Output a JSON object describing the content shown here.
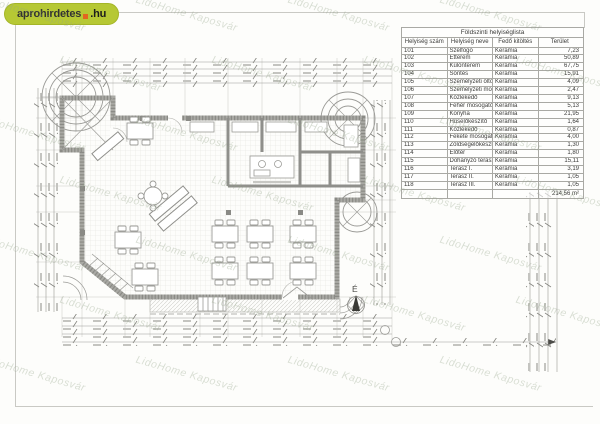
{
  "logo": {
    "text_main": "aprohirdetes",
    "text_tld": ".hu"
  },
  "watermark": {
    "text": "LidoHome Kaposvár"
  },
  "plan": {
    "north_label": "É"
  },
  "room_table": {
    "title": "Földszinti helyiséglista",
    "columns": [
      "Helyiség szám",
      "Helyiség neve",
      "Fedő kitöltés",
      "Terület"
    ],
    "row_keys": [
      "num",
      "name",
      "finish",
      "area"
    ],
    "rows": [
      {
        "num": "101",
        "name": "Szélfogó",
        "finish": "Kerámia",
        "area": "7,23"
      },
      {
        "num": "102",
        "name": "Étterem",
        "finish": "Kerámia",
        "area": "50,89"
      },
      {
        "num": "103",
        "name": "Különterem",
        "finish": "Kerámia",
        "area": "67,75"
      },
      {
        "num": "104",
        "name": "Söntés",
        "finish": "Kerámia",
        "area": "15,91"
      },
      {
        "num": "105",
        "name": "Személyzeti öltöző",
        "finish": "Kerámia",
        "area": "4,09"
      },
      {
        "num": "106",
        "name": "Személyzeti mosdó",
        "finish": "Kerámia",
        "area": "2,47"
      },
      {
        "num": "107",
        "name": "Közlekedő",
        "finish": "Kerámia",
        "area": "9,13"
      },
      {
        "num": "108",
        "name": "Fehér mosogató",
        "finish": "Kerámia",
        "area": "5,13"
      },
      {
        "num": "109",
        "name": "Konyha",
        "finish": "Kerámia",
        "area": "21,95"
      },
      {
        "num": "110",
        "name": "Húselőkészítő",
        "finish": "Kerámia",
        "area": "1,64"
      },
      {
        "num": "111",
        "name": "Közlekedő",
        "finish": "Kerámia",
        "area": "0,87"
      },
      {
        "num": "112",
        "name": "Fekete mosogató",
        "finish": "Kerámia",
        "area": "4,00"
      },
      {
        "num": "113",
        "name": "Zöldségelőkészítő",
        "finish": "Kerámia",
        "area": "1,30"
      },
      {
        "num": "114",
        "name": "Előtér",
        "finish": "Kerámia",
        "area": "1,80"
      },
      {
        "num": "115",
        "name": "Dohányzó terasz",
        "finish": "Kerámia",
        "area": "15,11"
      },
      {
        "num": "116",
        "name": "Terasz I.",
        "finish": "Kerámia",
        "area": "3,19"
      },
      {
        "num": "117",
        "name": "Terasz II.",
        "finish": "Kerámia",
        "area": "1,05"
      },
      {
        "num": "118",
        "name": "Terasz III.",
        "finish": "Kerámia",
        "area": "1,05"
      }
    ],
    "total": "214,56 m²"
  },
  "colors": {
    "logo_bg": "#b6c834",
    "logo_dot": "#e2661f",
    "watermark": "#94a489",
    "wall": "#8f8f8b",
    "dim_line": "#9a9a96"
  }
}
